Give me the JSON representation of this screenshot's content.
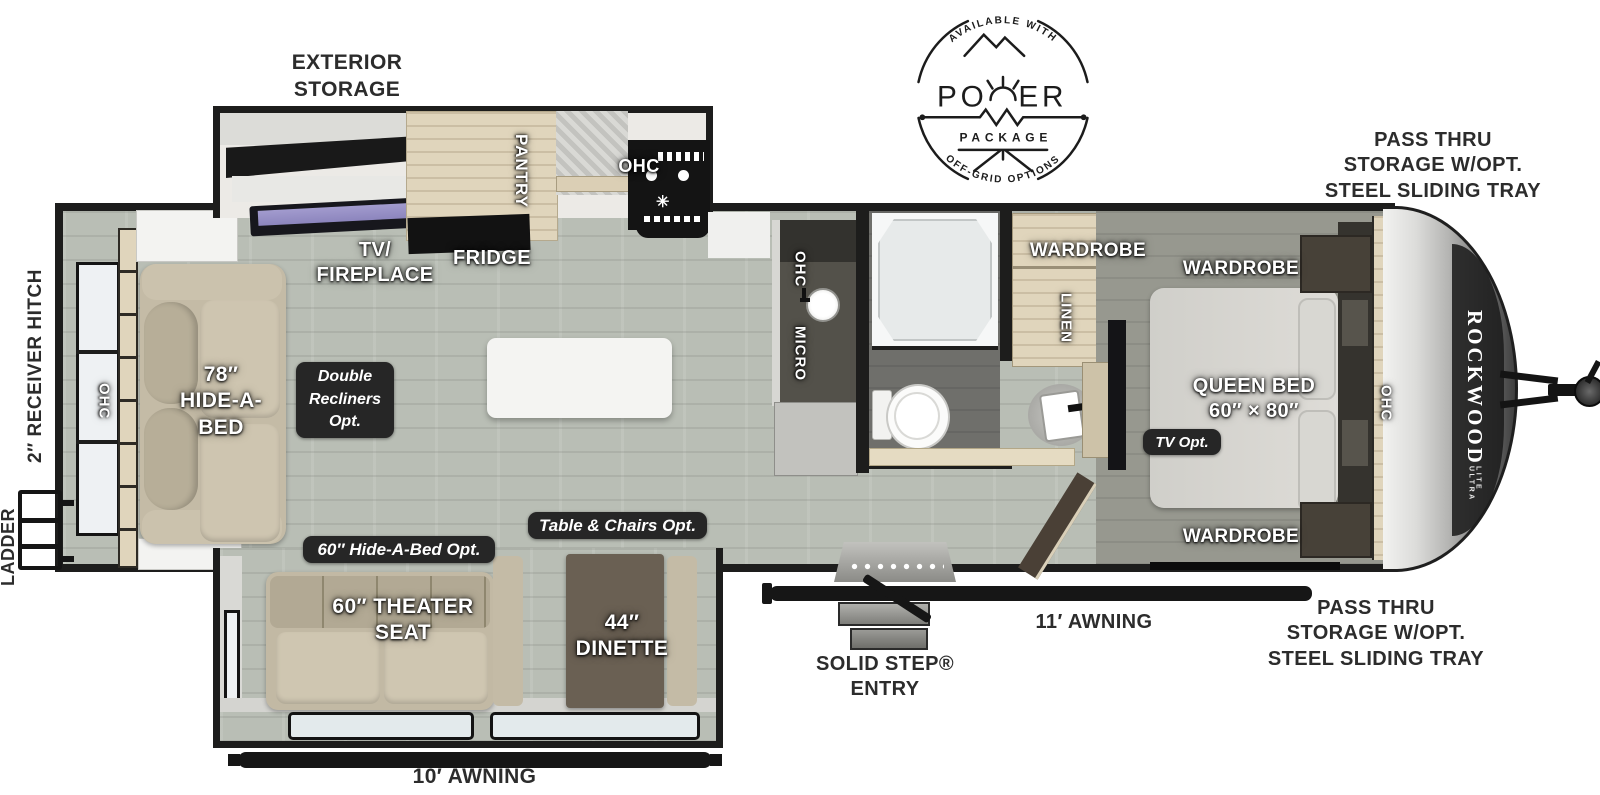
{
  "colors": {
    "wall": "#1d1d1c",
    "floor": "#b9beb5",
    "bedroom_floor": "#97988f",
    "bath_floor": "#6f6f6b",
    "wood_cabinet": "#e0d5bc",
    "furniture_tan": "#c6bda8",
    "badge_bg": "#262626",
    "label_dark": "#2c2c2c",
    "tv_screen": "#9a93c8",
    "appliance_black": "#141414"
  },
  "logo": {
    "arc_top": "AVAILABLE WITH",
    "power_left": "PO",
    "power_right": "ER",
    "package": "PACKAGE",
    "arc_bottom": "OFF-GRID OPTIONS"
  },
  "exterior": {
    "storage": "EXTERIOR\nSTORAGE",
    "pass_thru_front_top": "PASS THRU\nSTORAGE W/OPT.\nSTEEL SLIDING TRAY",
    "pass_thru_front_bottom": "PASS THRU\nSTORAGE W/OPT.\nSTEEL SLIDING TRAY",
    "receiver_hitch": "2″ RECEIVER HITCH",
    "ladder": "LADDER",
    "awning_main": "11′ AWNING",
    "awning_slide": "10′ AWNING",
    "entry": "SOLID STEP®\nENTRY"
  },
  "living": {
    "ohc_rear": "OHC",
    "hide_a_bed": "78″\nHIDE-A-\nBED",
    "double_recliners_opt": "Double\nRecliners\nOpt.",
    "tv_fireplace": "TV/\nFIREPLACE",
    "fridge": "FRIDGE"
  },
  "kitchen": {
    "pantry": "PANTRY",
    "ohc_range": "OHC",
    "ohc_counter": "OHC",
    "micro": "MICRO"
  },
  "slideout": {
    "hide_a_bed_opt": "60″ Hide-A-Bed Opt.",
    "theater_seat": "60″ THEATER\nSEAT",
    "table_chairs_opt": "Table & Chairs Opt.",
    "dinette": "44″\nDINETTE"
  },
  "bedroom": {
    "wardrobe_entry": "WARDROBE",
    "wardrobe_head_top": "WARDROBE",
    "wardrobe_head_bottom": "WARDROBE",
    "linen": "LINEN",
    "queen_bed": "QUEEN BED\n60″ × 80″",
    "tv_opt": "TV Opt.",
    "ohc": "OHC"
  },
  "brand": {
    "name": "ROCKWOOD",
    "sub": "ULTRA LITE"
  }
}
